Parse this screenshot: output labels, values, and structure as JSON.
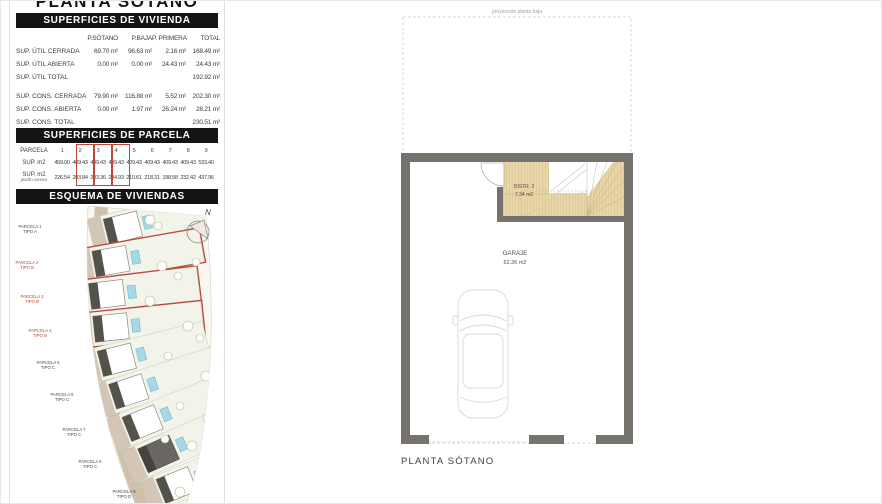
{
  "header": {
    "title": "PLANTA SÓTANO"
  },
  "colors": {
    "accent_red": "#c0463c",
    "wall_gray": "#76726e",
    "wood_beige": "#e9d6a8",
    "pool_blue": "#a6d9e8",
    "header_black": "#141414"
  },
  "vivienda_table": {
    "title": "SUPERFICIES DE VIVIENDA",
    "columns": [
      "P.SÓTANO",
      "P.BAJA",
      "P. PRIMERA",
      "TOTAL"
    ],
    "rows": [
      {
        "label": "SUP. ÚTIL CERRADA",
        "values": [
          "69.70 m²",
          "96.63 m²",
          "2.16 m²",
          "168.49 m²"
        ]
      },
      {
        "label": "SUP. ÚTIL ABIERTA",
        "values": [
          "0.00 m²",
          "0.00 m²",
          "24.43 m²",
          "24.43 m²"
        ]
      },
      {
        "label": "SUP. ÚTIL TOTAL",
        "values": [
          "",
          "",
          "",
          "192.92 m²"
        ]
      },
      {
        "label": "SUP. CONS. CERRADA",
        "values": [
          "79.90 m²",
          "116.88 m²",
          "5.52 m²",
          "202.30 m²"
        ]
      },
      {
        "label": "SUP. CONS. ABIERTA",
        "values": [
          "0.00 m²",
          "1.97 m²",
          "26.24 m²",
          "28.21 m²"
        ]
      },
      {
        "label": "SUP. CONS. TOTAL",
        "values": [
          "",
          "",
          "",
          "230.51 m²"
        ]
      }
    ]
  },
  "parcela_table": {
    "title": "SUPERFICIES DE PARCELA",
    "highlighted_parcels": [
      "2",
      "3",
      "4"
    ],
    "rows": [
      {
        "label": "PARCELA",
        "sub": "",
        "values": [
          "1",
          "2",
          "3",
          "4",
          "5",
          "6",
          "7",
          "8",
          "9"
        ]
      },
      {
        "label": "SUP. m2",
        "sub": "",
        "values": [
          "459.00",
          "409.43",
          "409.43",
          "409.43",
          "409.43",
          "409.43",
          "409.43",
          "409.43",
          "533.40"
        ]
      },
      {
        "label": "SUP. m2",
        "sub": "jardín anexo",
        "values": [
          "226.54",
          "203.84",
          "203.36",
          "204.93",
          "210.61",
          "218.31",
          "198.58",
          "232.42",
          "437.96"
        ]
      }
    ]
  },
  "esquema": {
    "title": "ESQUEMA DE VIVIENDAS",
    "north": "N",
    "parcels": [
      {
        "name": "PARCELA 1",
        "tipo": "TIPO A",
        "highlight": false
      },
      {
        "name": "PARCELA 2",
        "tipo": "TIPO B",
        "highlight": true
      },
      {
        "name": "PARCELA 3",
        "tipo": "TIPO B",
        "highlight": true
      },
      {
        "name": "PARCELA 4",
        "tipo": "TIPO B",
        "highlight": true
      },
      {
        "name": "PARCELA 5",
        "tipo": "TIPO C",
        "highlight": false
      },
      {
        "name": "PARCELA 6",
        "tipo": "TIPO C",
        "highlight": false
      },
      {
        "name": "PARCELA 7",
        "tipo": "TIPO C",
        "highlight": false
      },
      {
        "name": "PARCELA 8",
        "tipo": "TIPO C",
        "highlight": false
      },
      {
        "name": "PARCELA 9",
        "tipo": "TIPO D",
        "highlight": false
      }
    ]
  },
  "floor_plan": {
    "projection_label": "proyección planta baja",
    "distr": {
      "name": "DISTR. 2",
      "area": "7.34 m2"
    },
    "garaje": {
      "name": "GARAJE",
      "area": "62.36 m2"
    },
    "caption": "PLANTA SÓTANO"
  }
}
